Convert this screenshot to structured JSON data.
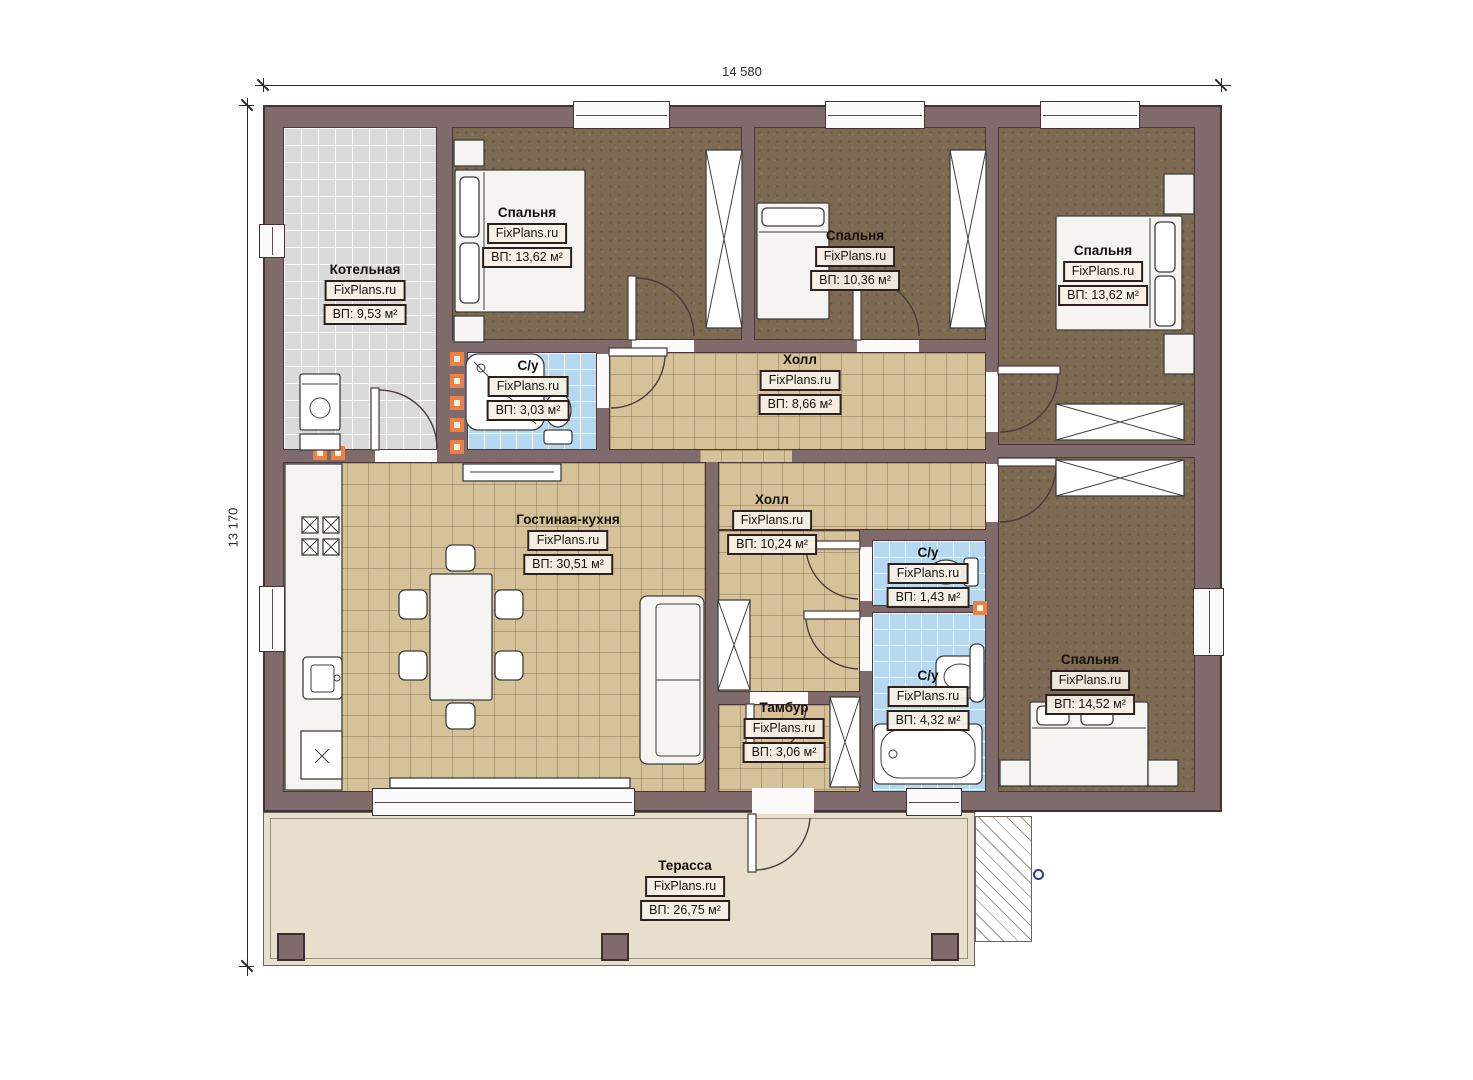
{
  "plan": {
    "top_dimension": "14 580",
    "left_dimension": "13 170"
  },
  "rooms": {
    "boiler": {
      "name": "Котельная",
      "brand": "FixPlans.ru",
      "area": "ВП: 9,53 м²"
    },
    "bedroom1": {
      "name": "Спальня",
      "brand": "FixPlans.ru",
      "area": "ВП: 13,62 м²"
    },
    "bedroom2": {
      "name": "Спальня",
      "brand": "FixPlans.ru",
      "area": "ВП: 10,36 м²"
    },
    "bedroom3": {
      "name": "Спальня",
      "brand": "FixPlans.ru",
      "area": "ВП: 13,62 м²"
    },
    "bath1": {
      "name": "С/у",
      "brand": "FixPlans.ru",
      "area": "ВП: 3,03 м²"
    },
    "hall1": {
      "name": "Холл",
      "brand": "FixPlans.ru",
      "area": "ВП: 8,66 м²"
    },
    "living": {
      "name": "Гостиная-кухня",
      "brand": "FixPlans.ru",
      "area": "ВП: 30,51 м²"
    },
    "hall2": {
      "name": "Холл",
      "brand": "FixPlans.ru",
      "area": "ВП: 10,24 м²"
    },
    "bath2": {
      "name": "С/у",
      "brand": "FixPlans.ru",
      "area": "ВП: 1,43 м²"
    },
    "bath3": {
      "name": "С/у",
      "brand": "FixPlans.ru",
      "area": "ВП: 4,32 м²"
    },
    "bedroom4": {
      "name": "Спальня",
      "brand": "FixPlans.ru",
      "area": "ВП: 14,52 м²"
    },
    "vestibule": {
      "name": "Тамбур",
      "brand": "FixPlans.ru",
      "area": "ВП: 3,06 м²"
    },
    "terrace": {
      "name": "Терасса",
      "brand": "FixPlans.ru",
      "area": "ВП: 26,75 м²"
    }
  },
  "colors": {
    "wall": "#7f6a6c",
    "tile": "#d6c299",
    "bath_tile": "#b7d8f1",
    "boiler_tile": "#dadada",
    "bedroom_floor": "#7c6a52",
    "terrace_floor": "#e7decb",
    "vent_accent": "#ec8045"
  }
}
